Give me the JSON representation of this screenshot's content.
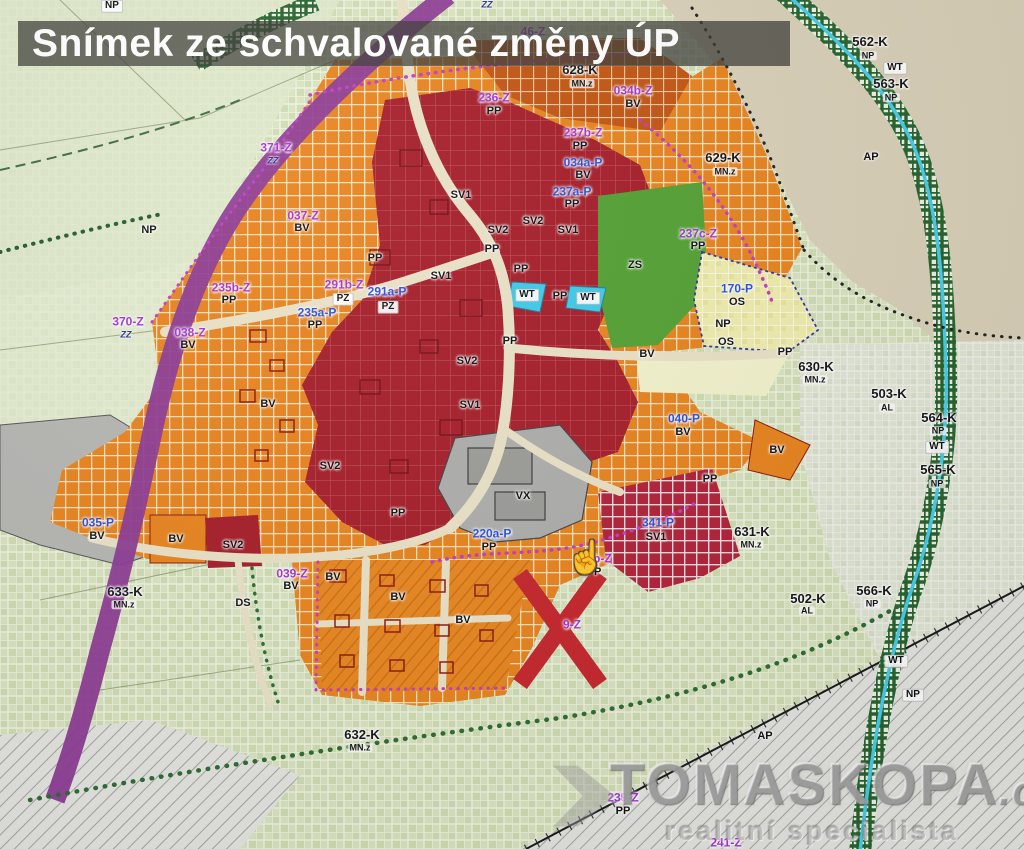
{
  "title": {
    "text": "Snímek ze schvalované změny ÚP"
  },
  "watermark": {
    "brand": "TOMASKOPA",
    "suffix": ".cz",
    "tagline": "realitní specialista"
  },
  "annotation": {
    "x_mark": "X",
    "cursor_icon": "pointing-hand-cursor"
  },
  "palette": {
    "c-z": "#a435d2",
    "c-p": "#2b50e0",
    "c-x": "#c5262c",
    "c-bv": "#e8831d",
    "c-sv": "#a51c28",
    "c-zs": "#53a033",
    "c-os": "#efedae",
    "c-wt": "#3fc9e8",
    "c-vx": "#ababab",
    "c-road": "#8c3a94",
    "c-field": "#d9e4c0",
    "c-tan": "#d9d0b8"
  },
  "map": {
    "labels": [
      {
        "t": "NP",
        "x": 112,
        "y": 6,
        "s": "box"
      },
      {
        "t": "ZZ",
        "x": 487,
        "y": 5,
        "s": "zz"
      },
      {
        "t": "46-Z",
        "x": 533,
        "y": 32,
        "s": "z"
      },
      {
        "t": "628-K",
        "x": 580,
        "y": 70,
        "s": "k"
      },
      {
        "t": "MN.z",
        "x": 582,
        "y": 84,
        "s": "ks"
      },
      {
        "t": "562-K",
        "x": 870,
        "y": 42,
        "s": "k"
      },
      {
        "t": "NP",
        "x": 868,
        "y": 56,
        "s": "ks"
      },
      {
        "t": "WT",
        "x": 895,
        "y": 68,
        "s": "box"
      },
      {
        "t": "563-K",
        "x": 891,
        "y": 84,
        "s": "k"
      },
      {
        "t": "NP",
        "x": 891,
        "y": 98,
        "s": "ks"
      },
      {
        "t": "629-K",
        "x": 723,
        "y": 158,
        "s": "k"
      },
      {
        "t": "MN.z",
        "x": 725,
        "y": 172,
        "s": "ks"
      },
      {
        "t": "AP",
        "x": 871,
        "y": 158,
        "s": "a"
      },
      {
        "t": "236-Z",
        "x": 494,
        "y": 98,
        "s": "z"
      },
      {
        "t": "PP",
        "x": 494,
        "y": 112,
        "s": "a"
      },
      {
        "t": "034b-Z",
        "x": 633,
        "y": 91,
        "s": "z"
      },
      {
        "t": "BV",
        "x": 633,
        "y": 105,
        "s": "a"
      },
      {
        "t": "237b-Z",
        "x": 583,
        "y": 133,
        "s": "z"
      },
      {
        "t": "PP",
        "x": 580,
        "y": 147,
        "s": "a"
      },
      {
        "t": "034a-P",
        "x": 583,
        "y": 163,
        "s": "p"
      },
      {
        "t": "BV",
        "x": 583,
        "y": 176,
        "s": "a"
      },
      {
        "t": "237a-P",
        "x": 572,
        "y": 192,
        "s": "p"
      },
      {
        "t": "PP",
        "x": 572,
        "y": 205,
        "s": "a"
      },
      {
        "t": "371-Z",
        "x": 276,
        "y": 148,
        "s": "z"
      },
      {
        "t": "ZZ",
        "x": 273,
        "y": 161,
        "s": "zz"
      },
      {
        "t": "037-Z",
        "x": 303,
        "y": 216,
        "s": "z"
      },
      {
        "t": "BV",
        "x": 302,
        "y": 229,
        "s": "a"
      },
      {
        "t": "NP",
        "x": 149,
        "y": 231,
        "s": "a"
      },
      {
        "t": "SV1",
        "x": 461,
        "y": 196,
        "s": "a"
      },
      {
        "t": "SV2",
        "x": 533,
        "y": 222,
        "s": "a"
      },
      {
        "t": "SV1",
        "x": 568,
        "y": 231,
        "s": "a"
      },
      {
        "t": "SV2",
        "x": 498,
        "y": 231,
        "s": "a"
      },
      {
        "t": "PP",
        "x": 492,
        "y": 250,
        "s": "a"
      },
      {
        "t": "PP",
        "x": 375,
        "y": 259,
        "s": "a"
      },
      {
        "t": "SV1",
        "x": 441,
        "y": 277,
        "s": "a"
      },
      {
        "t": "PP",
        "x": 521,
        "y": 270,
        "s": "a"
      },
      {
        "t": "235b-Z",
        "x": 231,
        "y": 288,
        "s": "z"
      },
      {
        "t": "PP",
        "x": 229,
        "y": 301,
        "s": "a"
      },
      {
        "t": "291b-Z",
        "x": 344,
        "y": 285,
        "s": "z"
      },
      {
        "t": "PZ",
        "x": 343,
        "y": 299,
        "s": "box"
      },
      {
        "t": "291a-P",
        "x": 387,
        "y": 292,
        "s": "p"
      },
      {
        "t": "PZ",
        "x": 388,
        "y": 307,
        "s": "box"
      },
      {
        "t": "235a-P",
        "x": 317,
        "y": 313,
        "s": "p"
      },
      {
        "t": "PP",
        "x": 315,
        "y": 326,
        "s": "a"
      },
      {
        "t": "370-Z",
        "x": 128,
        "y": 322,
        "s": "z"
      },
      {
        "t": "ZZ",
        "x": 126,
        "y": 335,
        "s": "zz"
      },
      {
        "t": "038-Z",
        "x": 190,
        "y": 333,
        "s": "z"
      },
      {
        "t": "BV",
        "x": 188,
        "y": 346,
        "s": "a"
      },
      {
        "t": "WT",
        "x": 527,
        "y": 295,
        "s": "box"
      },
      {
        "t": "PP",
        "x": 560,
        "y": 297,
        "s": "a"
      },
      {
        "t": "WT",
        "x": 588,
        "y": 298,
        "s": "box"
      },
      {
        "t": "237c-Z",
        "x": 698,
        "y": 234,
        "s": "z"
      },
      {
        "t": "PP",
        "x": 698,
        "y": 247,
        "s": "a"
      },
      {
        "t": "ZS",
        "x": 635,
        "y": 266,
        "s": "a"
      },
      {
        "t": "170-P",
        "x": 737,
        "y": 289,
        "s": "p"
      },
      {
        "t": "OS",
        "x": 737,
        "y": 303,
        "s": "a"
      },
      {
        "t": "NP",
        "x": 723,
        "y": 325,
        "s": "a"
      },
      {
        "t": "OS",
        "x": 726,
        "y": 343,
        "s": "a"
      },
      {
        "t": "PP",
        "x": 785,
        "y": 353,
        "s": "a"
      },
      {
        "t": "PP",
        "x": 510,
        "y": 342,
        "s": "a"
      },
      {
        "t": "SV2",
        "x": 467,
        "y": 362,
        "s": "a"
      },
      {
        "t": "SV1",
        "x": 470,
        "y": 406,
        "s": "a"
      },
      {
        "t": "BV",
        "x": 647,
        "y": 355,
        "s": "a"
      },
      {
        "t": "630-K",
        "x": 816,
        "y": 367,
        "s": "k"
      },
      {
        "t": "MN.z",
        "x": 815,
        "y": 380,
        "s": "ks"
      },
      {
        "t": "503-K",
        "x": 889,
        "y": 394,
        "s": "k"
      },
      {
        "t": "AL",
        "x": 887,
        "y": 408,
        "s": "ks"
      },
      {
        "t": "564-K",
        "x": 939,
        "y": 418,
        "s": "k"
      },
      {
        "t": "NP",
        "x": 938,
        "y": 431,
        "s": "ks"
      },
      {
        "t": "WT",
        "x": 937,
        "y": 447,
        "s": "box"
      },
      {
        "t": "565-K",
        "x": 938,
        "y": 470,
        "s": "k"
      },
      {
        "t": "NP",
        "x": 937,
        "y": 484,
        "s": "ks"
      },
      {
        "t": "040-P",
        "x": 684,
        "y": 419,
        "s": "p"
      },
      {
        "t": "BV",
        "x": 683,
        "y": 433,
        "s": "a"
      },
      {
        "t": "BV",
        "x": 777,
        "y": 451,
        "s": "a"
      },
      {
        "t": "PP",
        "x": 710,
        "y": 480,
        "s": "a"
      },
      {
        "t": "BV",
        "x": 268,
        "y": 405,
        "s": "a"
      },
      {
        "t": "SV2",
        "x": 330,
        "y": 467,
        "s": "a"
      },
      {
        "t": "PP",
        "x": 398,
        "y": 514,
        "s": "a"
      },
      {
        "t": "VX",
        "x": 523,
        "y": 497,
        "s": "a"
      },
      {
        "t": "341-P",
        "x": 658,
        "y": 523,
        "s": "p"
      },
      {
        "t": "SV1",
        "x": 656,
        "y": 538,
        "s": "a"
      },
      {
        "t": "631-K",
        "x": 752,
        "y": 532,
        "s": "k"
      },
      {
        "t": "MN.z",
        "x": 751,
        "y": 545,
        "s": "ks"
      },
      {
        "t": "035-P",
        "x": 98,
        "y": 523,
        "s": "p"
      },
      {
        "t": "BV",
        "x": 97,
        "y": 537,
        "s": "a"
      },
      {
        "t": "BV",
        "x": 176,
        "y": 540,
        "s": "a"
      },
      {
        "t": "SV2",
        "x": 233,
        "y": 546,
        "s": "a"
      },
      {
        "t": "220a-P",
        "x": 492,
        "y": 534,
        "s": "p"
      },
      {
        "t": "PP",
        "x": 489,
        "y": 548,
        "s": "a"
      },
      {
        "t": "0b-Z",
        "x": 599,
        "y": 559,
        "s": "z"
      },
      {
        "t": "PP",
        "x": 594,
        "y": 573,
        "s": "a"
      },
      {
        "t": "9-Z",
        "x": 572,
        "y": 625,
        "s": "z"
      },
      {
        "t": "039-Z",
        "x": 292,
        "y": 574,
        "s": "z"
      },
      {
        "t": "BV",
        "x": 291,
        "y": 587,
        "s": "a"
      },
      {
        "t": "633-K",
        "x": 125,
        "y": 592,
        "s": "k"
      },
      {
        "t": "MN.z",
        "x": 124,
        "y": 605,
        "s": "ks"
      },
      {
        "t": "DS",
        "x": 243,
        "y": 604,
        "s": "a"
      },
      {
        "t": "BV",
        "x": 333,
        "y": 578,
        "s": "a"
      },
      {
        "t": "BV",
        "x": 398,
        "y": 598,
        "s": "a"
      },
      {
        "t": "BV",
        "x": 463,
        "y": 621,
        "s": "a"
      },
      {
        "t": "632-K",
        "x": 362,
        "y": 735,
        "s": "k"
      },
      {
        "t": "MN.z",
        "x": 360,
        "y": 748,
        "s": "ks"
      },
      {
        "t": "502-K",
        "x": 808,
        "y": 599,
        "s": "k"
      },
      {
        "t": "AL",
        "x": 807,
        "y": 611,
        "s": "ks"
      },
      {
        "t": "566-K",
        "x": 874,
        "y": 591,
        "s": "k"
      },
      {
        "t": "NP",
        "x": 872,
        "y": 604,
        "s": "ks"
      },
      {
        "t": "WT",
        "x": 896,
        "y": 661,
        "s": "box"
      },
      {
        "t": "NP",
        "x": 913,
        "y": 695,
        "s": "box"
      },
      {
        "t": "AP",
        "x": 765,
        "y": 737,
        "s": "a"
      },
      {
        "t": "239-Z",
        "x": 623,
        "y": 798,
        "s": "z"
      },
      {
        "t": "PP",
        "x": 623,
        "y": 812,
        "s": "a"
      },
      {
        "t": "241-Z",
        "x": 726,
        "y": 843,
        "s": "z"
      }
    ]
  }
}
